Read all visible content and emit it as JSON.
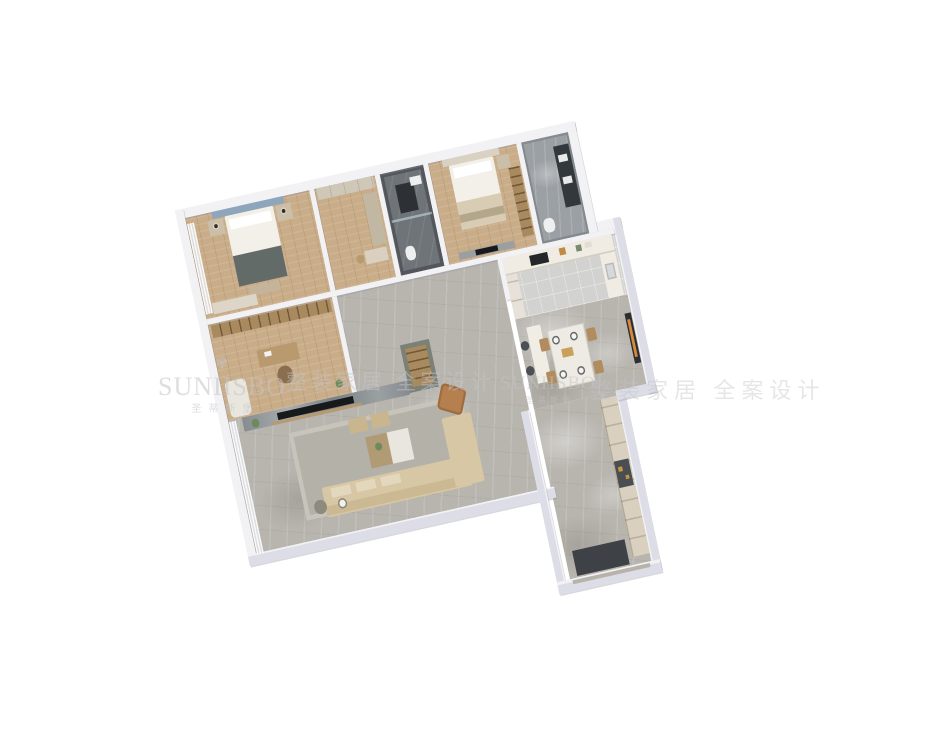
{
  "scene": {
    "description": "3D isometric render of an apartment floor plan on a white background",
    "background": "#ffffff"
  },
  "watermark": {
    "logo_icon": "✾",
    "brand_left": "SUNIISBO",
    "brand_center": "SUNHSBO",
    "brand_cn": "圣蒂斯堡",
    "slogan": "整装家居 全案设计"
  },
  "rooms": [
    "master-bedroom",
    "walk-in-closet",
    "bathroom-1",
    "bedroom-2",
    "bathroom-2",
    "study",
    "hallway",
    "kitchen",
    "dining-room",
    "living-room",
    "balcony-windows",
    "entry-corridor"
  ],
  "colors": {
    "bg": "#ffffff",
    "wall": "#f2f2f5",
    "wall_face": "#dcdde6",
    "floor_wood": "#c9ad89",
    "floor_marble": "#b8b5af",
    "floor_tile_dark": "#6e7478",
    "floor_tile_gray": "#9ba0a4",
    "floor_kitchen": "#d2d3d1",
    "sofa": "#d8c7a4",
    "sofa_back": "#cbb993",
    "accent_chair": "#b57f4e",
    "headboard_blue": "#8ea6bc",
    "cabinet_olive": "#7c8177",
    "wood_shelf": "#a9895e",
    "tv_black": "#17191b",
    "art_orange": "#d68a3a",
    "bed_white": "#f3f0e9",
    "blanket_dark": "#636b68",
    "counter_white": "#f0ece3",
    "entry_cabinet": "#d9d0c0",
    "mat_dark": "#3e4247",
    "watermark": "#c4c4c8"
  }
}
